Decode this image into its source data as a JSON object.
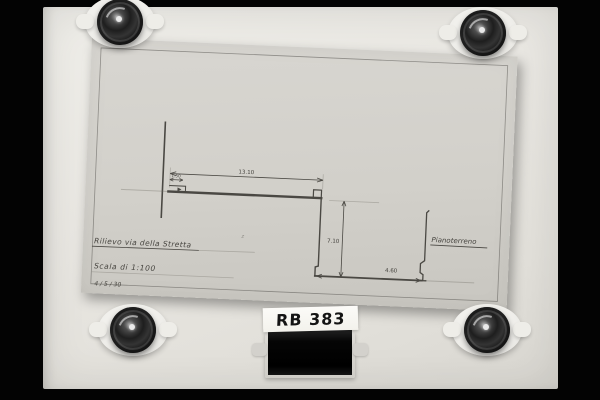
{
  "meta": {
    "catalog_label": "RB 383"
  },
  "colors": {
    "background": "#030303",
    "board": "#e8e6e1",
    "sheet": "#d2d0ca",
    "pencil_ink": "#4a4843",
    "label_ink": "#141414"
  },
  "sheet_text": {
    "title": "Rilievo via della Stretta",
    "scale": "Scala di 1:100",
    "date": "4 / 5 / 30",
    "right_label": "Pianoterreno",
    "stray_mark": "z"
  },
  "dimensions": {
    "top_span": "13.10",
    "upper_small": "1.50",
    "vertical_drop": "7.10",
    "bottom_span": "4.60"
  },
  "icons": {
    "corner_fastener": "metal-knob-clamp",
    "washer": "white-washer-with-tabs",
    "film_strip": "black-film-strip"
  }
}
